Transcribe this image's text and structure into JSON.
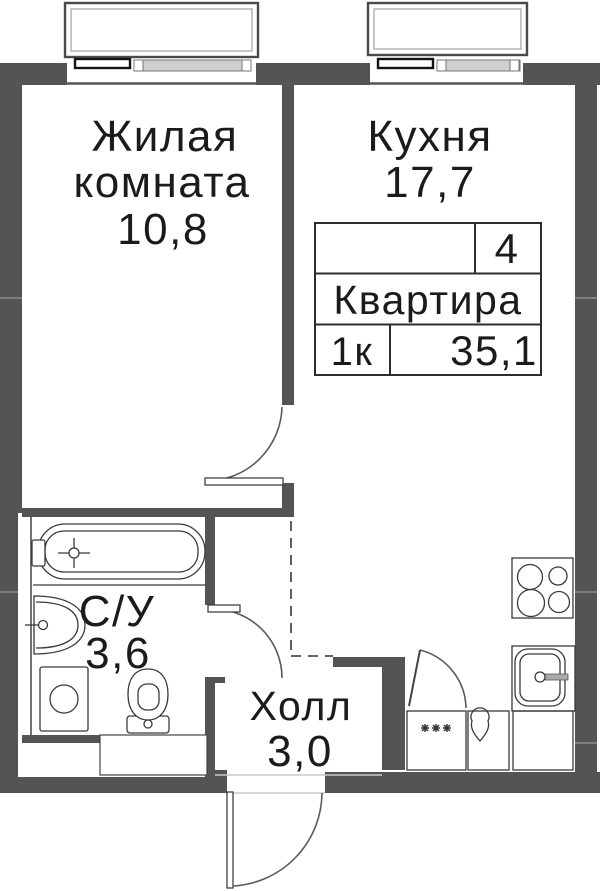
{
  "rooms": {
    "living": {
      "name": "Жилая",
      "name2": "комната",
      "area": "10,8"
    },
    "kitchen": {
      "name": "Кухня",
      "area": "17,7"
    },
    "bathroom": {
      "name": "С/У",
      "area": "3,6"
    },
    "hall": {
      "name": "Холл",
      "area": "3,0"
    }
  },
  "info_table": {
    "number": "4",
    "label": "Квартира",
    "rooms_count": "1к",
    "total_area": "35,1"
  },
  "colors": {
    "wall": "#545454",
    "line": "#3a3a3a",
    "glass": "#cfcfcf",
    "text": "#1b1b1b",
    "background": "#ffffff"
  },
  "icons": [
    "window-icon",
    "bathtub-icon",
    "washbasin-icon",
    "toilet-icon",
    "washing-machine-icon",
    "stove-icon",
    "kitchen-sink-icon",
    "water-heater-icon",
    "appliance-box-icon",
    "door-swing-icon",
    "entrance-door-icon",
    "open-boundary-dashed"
  ]
}
